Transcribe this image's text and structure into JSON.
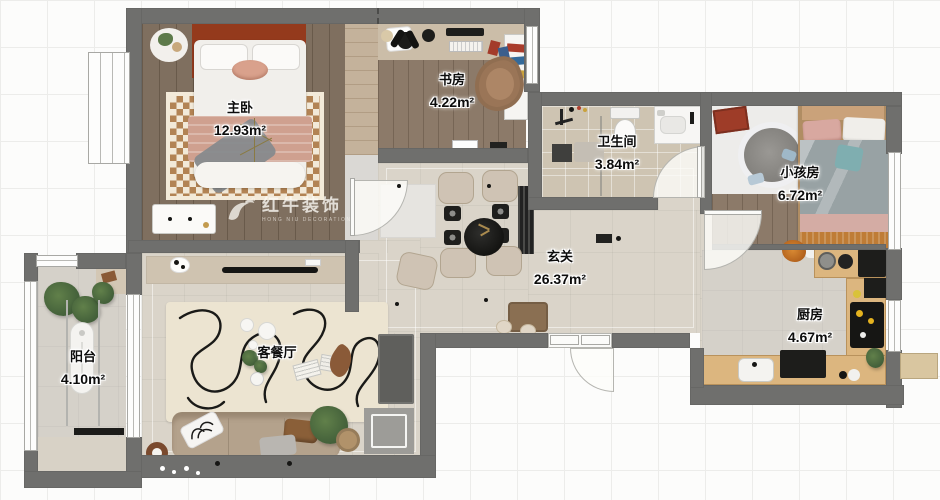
{
  "watermark": {
    "brand": "红牛装饰",
    "tagline": "HONG NIU DECORATION"
  },
  "rooms": [
    {
      "id": "master-bedroom",
      "name": "主卧",
      "area": "12.93m²"
    },
    {
      "id": "study",
      "name": "书房",
      "area": "4.22m²"
    },
    {
      "id": "bathroom",
      "name": "卫生间",
      "area": "3.84m²"
    },
    {
      "id": "kids-room",
      "name": "小孩房",
      "area": "6.72m²"
    },
    {
      "id": "hallway",
      "name": "玄关",
      "area": "26.37m²"
    },
    {
      "id": "kitchen",
      "name": "厨房",
      "area": "4.67m²"
    },
    {
      "id": "balcony",
      "name": "阳台",
      "area": "4.10m²"
    },
    {
      "id": "living-dining",
      "name": "客餐厅",
      "area": ""
    }
  ],
  "colors": {
    "wall": "#6f6f6d",
    "wood_dark": "#7f6f5f",
    "wood_mid": "#8c7a69",
    "bath_tile": "#cec4b2",
    "floor_beige": "#dad4c9",
    "kitchen_counter": "#dcb67f",
    "headboard_red": "#943a1c",
    "blanket_pink": "#cfa08f",
    "sofa_tan": "#b4a28c"
  }
}
